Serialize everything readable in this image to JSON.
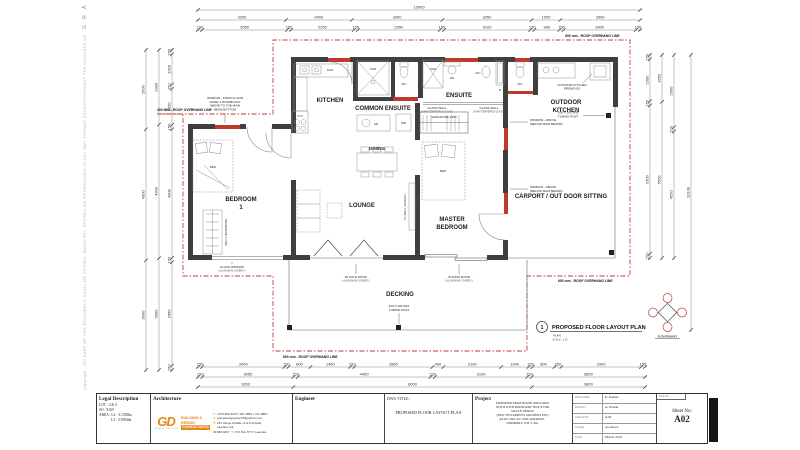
{
  "sheet": {
    "side_copyright": "copyright : NO PART OF THE DOCUMENT SHALL BE COPIED, MODIFIED, STORED OR REDESIGNED IN ANY WAY FORMAT EXCEPT/WITHOUT THE CONSENT OF",
    "side_brand": "G R A C E   D E S I G N"
  },
  "colors": {
    "wall": "#3f3f3f",
    "window_red": "#bf3a2b",
    "overhang_red": "#c43a3a",
    "logo_orange": "#e8841c",
    "thin_line": "#666"
  },
  "plan": {
    "rooms": {
      "kitchen": "KITCHEN",
      "common_ensuite": "COMMON ENSUITE",
      "ensuite": "ENSUITE",
      "outdoor_kitchen_1": "OUTDOOR",
      "outdoor_kitchen_2": "KITCHEN",
      "bedroom1_1": "BEDROOM",
      "bedroom1_2": "1",
      "lounge": "LOUNGE",
      "dining": "DINING",
      "master_1": "MASTER",
      "master_2": "BEDROOM",
      "carport": "CARPORT / OUT DOOR SITTING",
      "decking": "DECKING"
    },
    "fixtures": {
      "shr": "SHR",
      "wc": "WC",
      "b": "B",
      "hb": "HB",
      "wm": "WM",
      "stv": "STV",
      "ds": "D&S",
      "bed": "BED",
      "wardrobe": "WARDROBE 2350",
      "bed1_wardrobe": "BED 1 WARDROBE",
      "tv_joinery": "TV WALL JOINERY"
    },
    "annotations": {
      "window_note_1": "WINDOW - FROM FLOOR",
      "window_note_2": "LEVEL 1 ROW/BLOCK",
      "window_note_3": "ABOVE TO THE MAIN",
      "window_note_4": "BEAM BOTTOM",
      "roof_left": "400 MIN - ROOF OVERHANG LINE",
      "roof_top": "600 mm - ROOF OVERHANG LINE",
      "roof_right": "600 mm - ROOF OVERHANG LINE",
      "roof_bottom": "600 mm - ROOF OVERHANG LINE",
      "glass_wall": "GLASS WALL",
      "glass_wall_sub": "(6 MM TEMPERED GLASS)",
      "window_above": "WINDOW - ABOVE",
      "window_above_sub": "(BELOW MAIN BEAMS)",
      "tubing_1": "100 X 100 SHS",
      "tubing_2": "TUBING POST",
      "firewood_1": "OUTDOOR KITCHEN",
      "firewood_2": "FIREWOOD",
      "glass_window": "GLASS WINDOW",
      "bifold": "BI FOLD DOOR",
      "sliding": "SLIDING DOOR",
      "alu_sub": "(ALUMINIUM JOINERY)"
    },
    "title": {
      "number": "1",
      "label": "PROPOSED FLOOR LAYOUT PLAN",
      "sub1": "PLAN",
      "sub2": "SCALE : 1:50",
      "elevation_key": "ELEVATION KEY"
    }
  },
  "dimensions": {
    "top": [
      [
        15000
      ],
      [
        3200,
        2400,
        3300,
        3250,
        1050,
        2900
      ],
      [
        150,
        3050,
        150,
        2250,
        150,
        2950,
        150,
        3100,
        150,
        900,
        150,
        2600,
        150
      ]
    ],
    "bottom": [
      [
        150,
        3000,
        150,
        800,
        1450,
        150,
        2850,
        400,
        2100,
        1000,
        150,
        800,
        250,
        2900,
        150
      ],
      [
        150,
        3050,
        150,
        4450,
        150,
        3100,
        150,
        3800
      ],
      [
        3200,
        8000,
        3800
      ]
    ],
    "left": [
      [
        150,
        1000,
        150,
        1200,
        150,
        4300,
        150,
        3450,
        150
      ],
      [
        2400,
        4300,
        3600
      ],
      [
        2600,
        4300,
        3600
      ]
    ],
    "right": [
      [
        150,
        1500,
        150,
        5300,
        150
      ],
      [
        1650,
        5500
      ],
      [
        2600,
        150,
        4550
      ],
      [
        10100
      ]
    ]
  },
  "titleblock": {
    "legal": {
      "title": "Legal Description",
      "lot": "LOT : 2 & 3",
      "so": "SO : 9169",
      "area1": "AREA : L2 - 3.1530ha",
      "area2": "L3 - 3.5994ha"
    },
    "architecture": {
      "title": "Architecture",
      "logo": "GD",
      "logo_sub": "GRACE DESIGN",
      "line1": "BUILDING &",
      "line2": "DESIGN",
      "line3": "CONSULTANTS",
      "phone": "+679 999-9437 | 921-0887 | 721-0887",
      "email": "gracedesigngroup78@yahoo.com",
      "address1": "181 Vitogo Parade, A.N.Z Arcade,",
      "address2": "Lautoka, Fiji",
      "phone2": "666-9457",
      "pobox": "P.O Box 5777, Lautoka"
    },
    "engineer": {
      "title": "Engineer"
    },
    "dwg": {
      "label": "DWG TITLE:",
      "title": "PROPOSED FLOOR LAYOUT PLAN"
    },
    "project": {
      "label": "Project",
      "lines": [
        "PROPOSED FARM HOUSE AND FARM",
        "SETUP WITH BOUNDARY FENCE FOR",
        "GRACE DESIGN",
        "(NEW TESTAMENTS GROWERS PTE)",
        "@LOT: 2&3, SO: 9169, RAVIRAVI -",
        "FORMERLY LOT 2, BA."
      ]
    },
    "fields": [
      {
        "label": "DESIGNED",
        "value": "K. Kumar"
      },
      {
        "label": "DRAWN",
        "value": "A. Prasad"
      },
      {
        "label": "CHECKED",
        "value": "A.M"
      },
      {
        "label": "SCALE",
        "value": "As shown"
      },
      {
        "label": "DATE",
        "value": "March, 2023"
      }
    ],
    "sheetbox": {
      "file_label": "FILE NO",
      "sheet_label": "Sheet No:",
      "number": "A02"
    }
  }
}
